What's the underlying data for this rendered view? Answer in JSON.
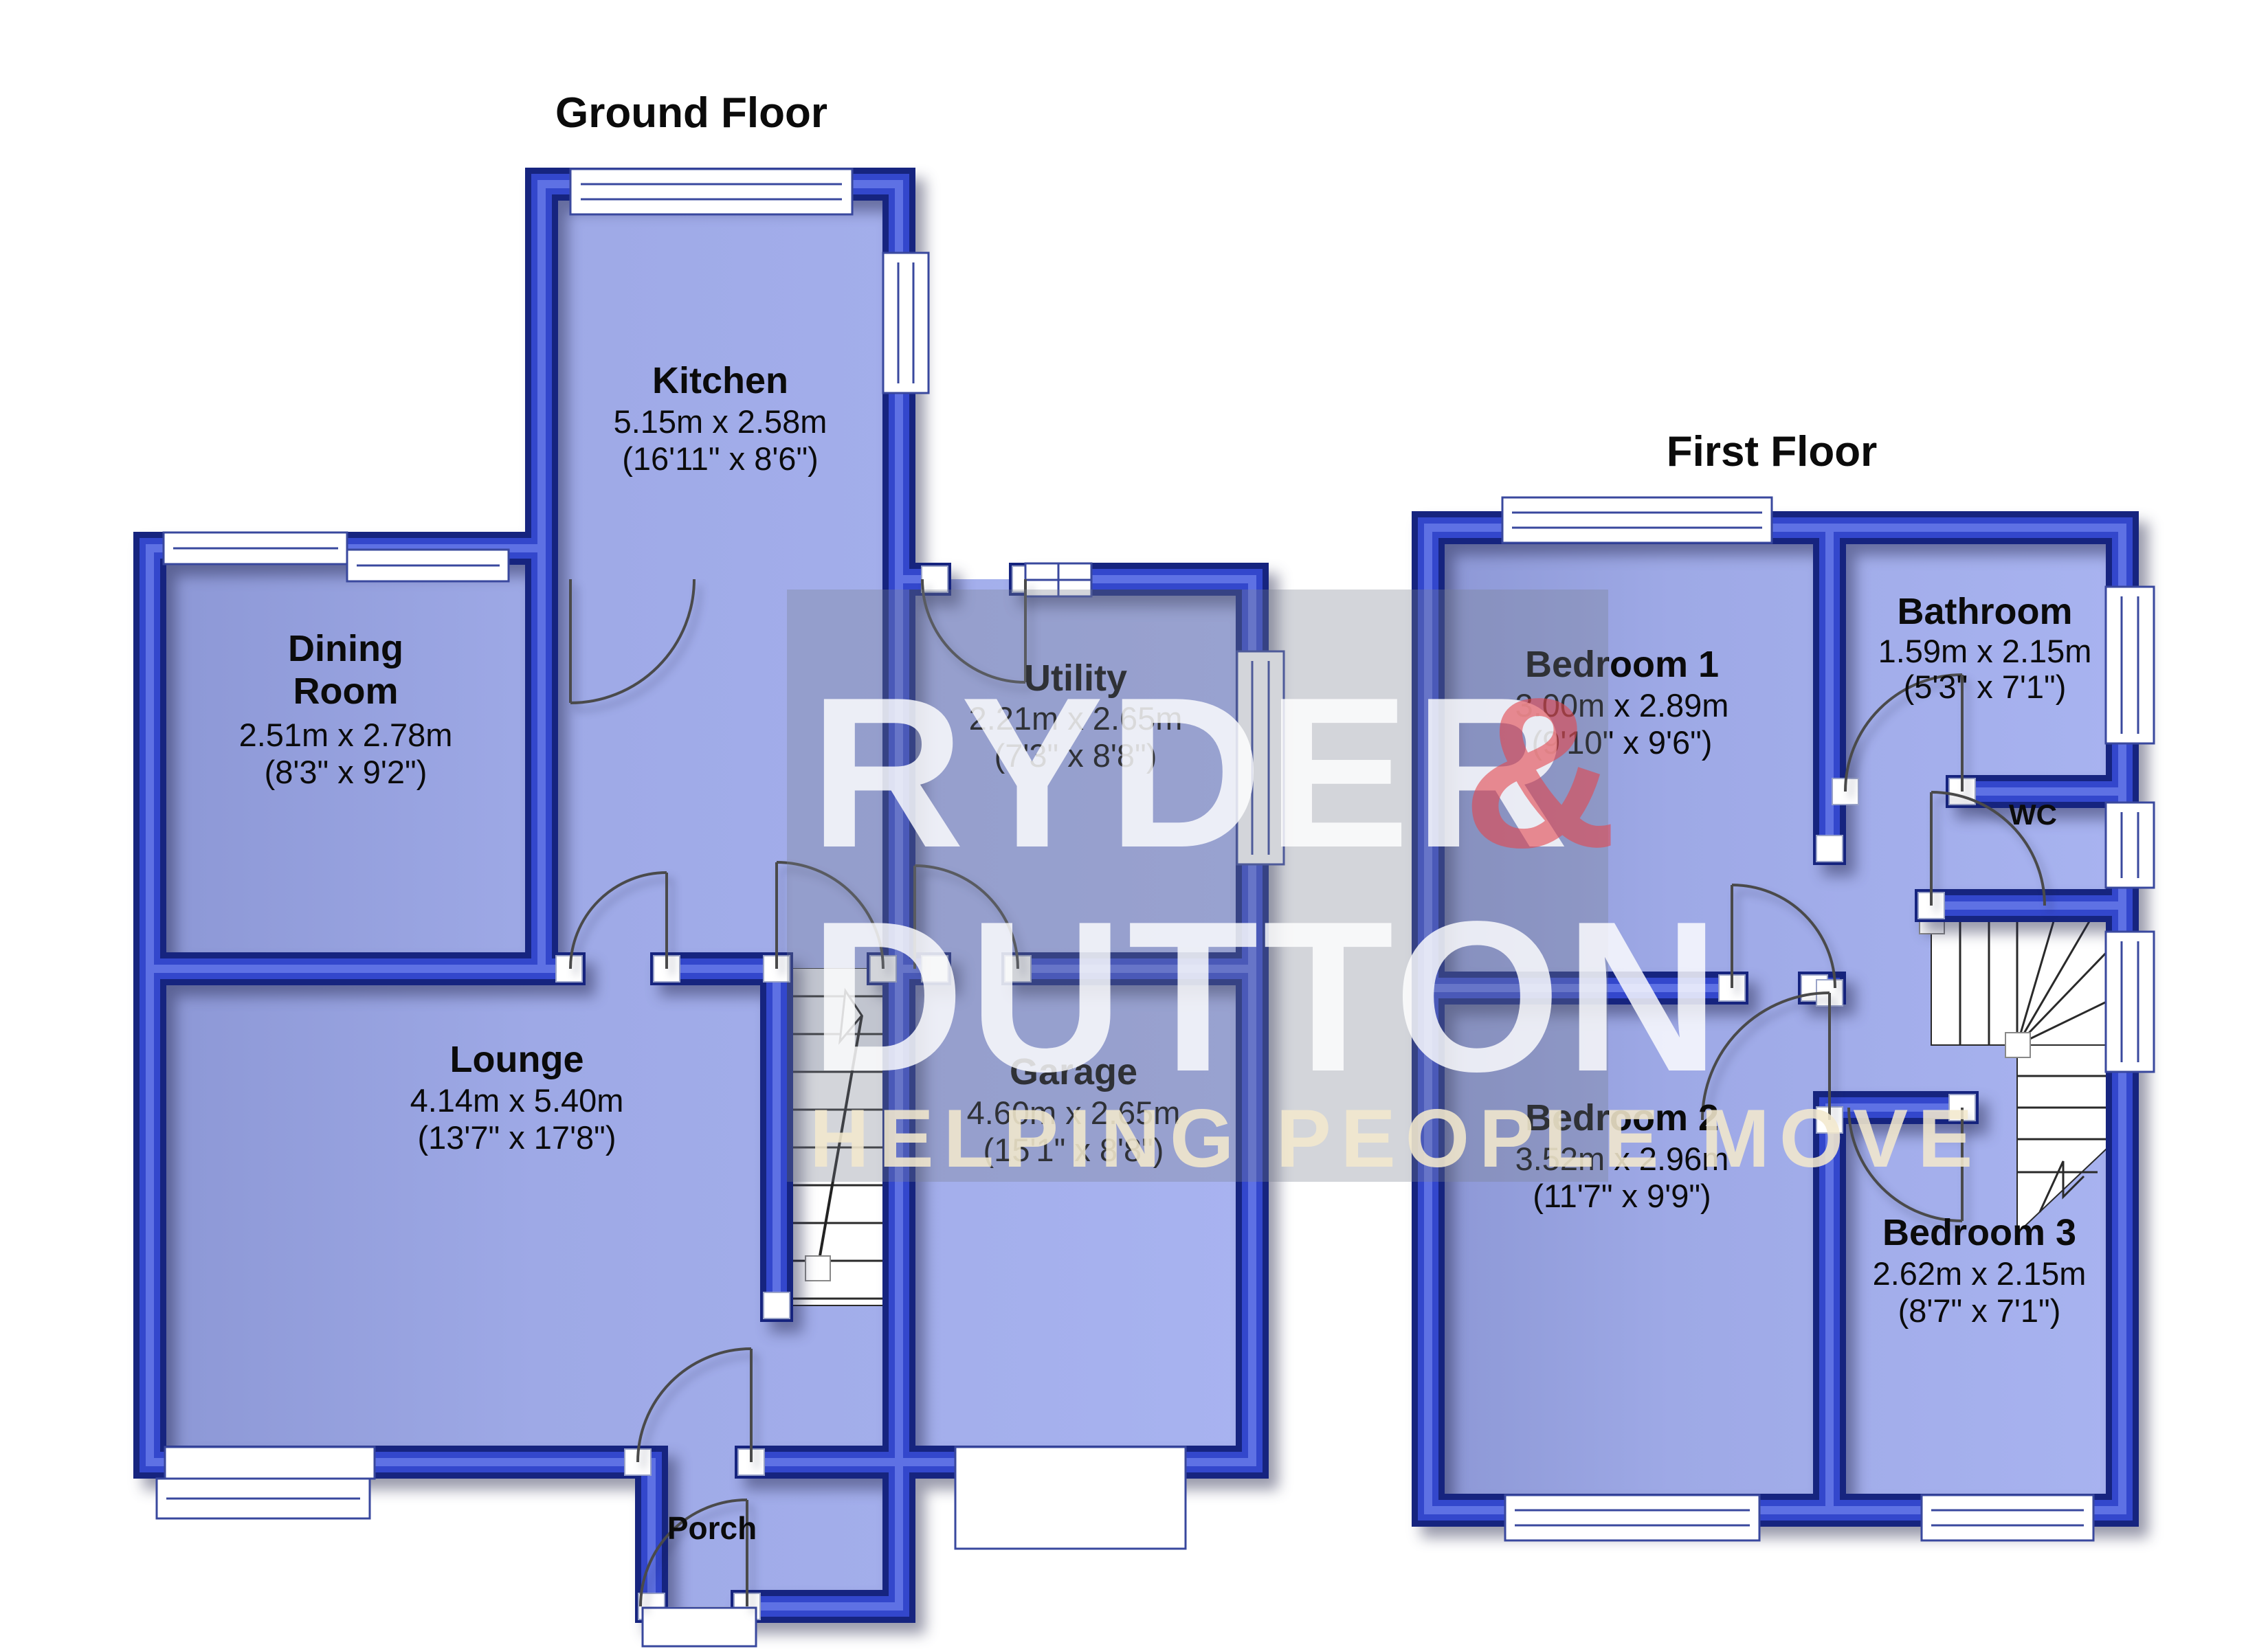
{
  "ground_floor": {
    "title": "Ground Floor",
    "rooms": [
      {
        "id": "kitchen",
        "name": "Kitchen",
        "dims_metric": "5.15m x 2.58m",
        "dims_imperial": "(16'11\" x 8'6\")"
      },
      {
        "id": "dining-room",
        "name": "Dining Room",
        "name_lines": [
          "Dining",
          "Room"
        ],
        "dims_metric": "2.51m x 2.78m",
        "dims_imperial": "(8'3\" x 9'2\")"
      },
      {
        "id": "utility",
        "name": "Utility",
        "dims_metric": "2.21m x 2.65m",
        "dims_imperial": "(7'3\" x 8'8\")"
      },
      {
        "id": "lounge",
        "name": "Lounge",
        "dims_metric": "4.14m x 5.40m",
        "dims_imperial": "(13'7\" x 17'8\")"
      },
      {
        "id": "garage",
        "name": "Garage",
        "dims_metric": "4.60m x 2.65m",
        "dims_imperial": "(15'1\" x 8'8\")"
      },
      {
        "id": "porch",
        "name": "Porch",
        "dims_metric": "",
        "dims_imperial": ""
      }
    ]
  },
  "first_floor": {
    "title": "First Floor",
    "rooms": [
      {
        "id": "bedroom-1",
        "name": "Bedroom 1",
        "dims_metric": "3.00m x 2.89m",
        "dims_imperial": "(9'10\" x 9'6\")"
      },
      {
        "id": "bathroom",
        "name": "Bathroom",
        "dims_metric": "1.59m x 2.15m",
        "dims_imperial": "(5'3\" x 7'1\")"
      },
      {
        "id": "wc",
        "name": "WC",
        "dims_metric": "",
        "dims_imperial": ""
      },
      {
        "id": "bedroom-2",
        "name": "Bedroom 2",
        "dims_metric": "3.52m x 2.96m",
        "dims_imperial": "(11'7\" x 9'9\")"
      },
      {
        "id": "bedroom-3",
        "name": "Bedroom 3",
        "dims_metric": "2.62m x 2.15m",
        "dims_imperial": "(8'7\" x 7'1\")"
      }
    ]
  },
  "watermark": {
    "brand_top": "RYDER",
    "brand_amp": "&",
    "brand_bottom": "DUTTON",
    "tagline": "HELPING PEOPLE MOVE"
  },
  "colors": {
    "wall_dark": "#16247f",
    "wall_mid": "#2c3dc0",
    "wall_light": "#5e71e4",
    "room_fill": "#a3aeec",
    "room_fill_dark": "#8c97d5",
    "window_stroke": "#39489e",
    "stair_line": "#2a2a2a",
    "watermark_gray": "rgba(120,126,142,0.33)",
    "watermark_white": "rgba(255,255,255,0.82)",
    "watermark_red": "rgba(226,70,76,0.60)",
    "watermark_cream": "rgba(242,232,205,0.88)"
  }
}
